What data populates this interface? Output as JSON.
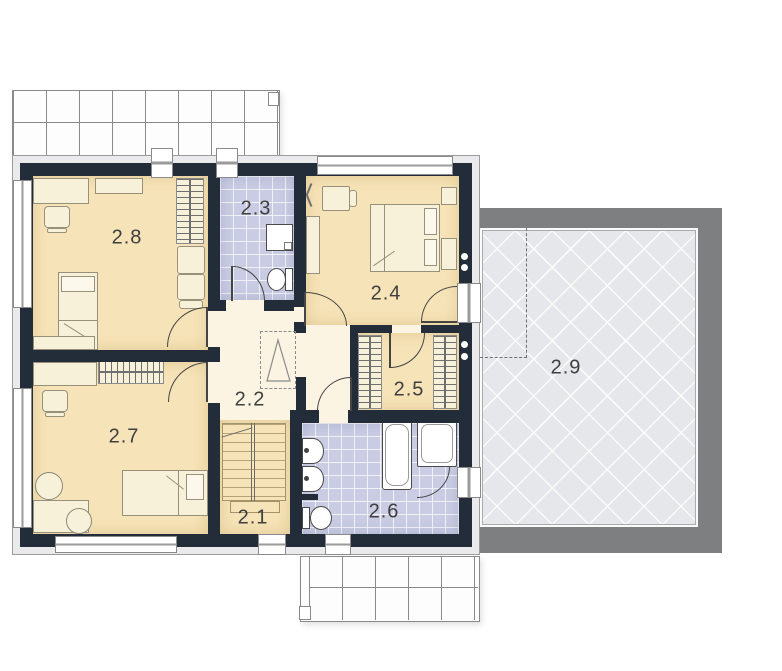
{
  "plan_title": "First floor plan",
  "rooms": {
    "r21": {
      "label": "2.1"
    },
    "r22": {
      "label": "2.2"
    },
    "r23": {
      "label": "2.3"
    },
    "r24": {
      "label": "2.4"
    },
    "r25": {
      "label": "2.5"
    },
    "r26": {
      "label": "2.6"
    },
    "r27": {
      "label": "2.7"
    },
    "r28": {
      "label": "2.8"
    },
    "r29": {
      "label": "2.9"
    }
  },
  "colors": {
    "wall": "#222D39",
    "bedroom_floor": "#F6E4B8",
    "bathroom_floor": "#C9CCE3",
    "hall_floor": "#FBF4E3",
    "exterior_band": "#EAEAEC",
    "terrace_frame": "#7E7F81",
    "terrace_floor": "#E6E7EA",
    "fixture_white": "#FFFFFF"
  }
}
